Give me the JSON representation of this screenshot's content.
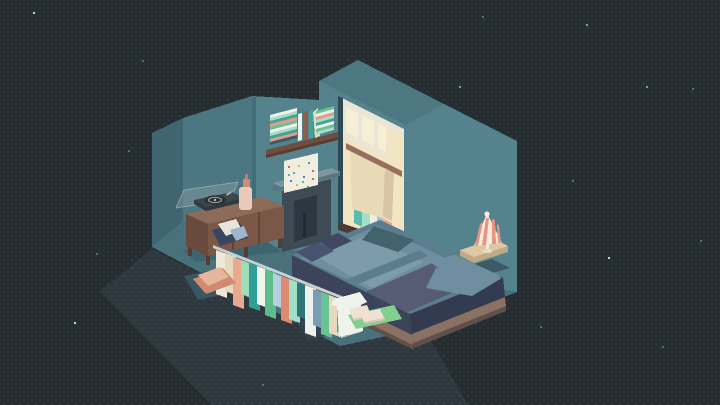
{
  "scene": {
    "description": "Isometric pixel-art bedroom diorama at night floating on a starry dark background",
    "objects": [
      "starry night background",
      "teal isometric room walls and roof",
      "record player on wooden sideboard",
      "pink bottle",
      "wall shelf with stacked books",
      "confetti wall art",
      "fireplace with mantel",
      "window with warm light",
      "closet nook with curtain and hanging clothes",
      "unmade bed with blue blankets",
      "bedside table with striped lamp",
      "clothes rack with hanging shirts",
      "peach floor cushion on rug",
      "slippers on green mat"
    ]
  },
  "palette": {
    "bg": "#262d31",
    "bg_dot": "#353d41",
    "star_white": "#c7d6d6",
    "star_teal": "#6fa3a8",
    "star_dim": "#5d6d72",
    "left_wall": "#4b7682",
    "left_wall_side": "#3f6570",
    "back_wall": "#54828d",
    "roof": "#4d7882",
    "corner_shade": "#436d78",
    "floor": "#48717c",
    "floor_shadow": "#3e6470",
    "bed_shadow": "#3a5a66",
    "rug_dark": "#3a5563",
    "rug_navy": "#3c4a66",
    "step_dark": "#32434e",
    "apron": "rgba(96,124,142,0.14)",
    "cabinet_top": "#8c6b59",
    "cabinet_front": "#7a5747",
    "cabinet_side": "#6a4a3c",
    "cabinet_leg": "#563c30",
    "cabinet_line": "#5f443a",
    "record_body": "#3c454b",
    "record_edge": "#31393e",
    "record_disc": "#2b3238",
    "record_ring": "#98a2a8",
    "record_lid": "rgba(158,170,176,0.35)",
    "bottle_body": "#eac9bb",
    "bottle_neck": "#d28a79",
    "bottle_tip": "#c97b68",
    "shelf_wood": "#6f4e3f",
    "shelf_edge": "#5a3d31",
    "art_bg": "#f0ede1",
    "art_speckles": [
      "#d95f54",
      "#52b3a8",
      "#e0b84f",
      "#4f7fc9",
      "#5a9e6f"
    ],
    "mantel_top": "#7e969e",
    "mantel_front": "#5d747d",
    "fireplace_body": "#3f4b54",
    "fireplace_inner": "#2c3840",
    "fireplace_detail": "#1f292f",
    "window_frame": "#e9e6d6",
    "closet_warm": "#f2e5c3",
    "closet_glow": "#f7eed6",
    "closet_rod": "#96705c",
    "curtain": "#e8d9b7",
    "curtain_shade": "#d8c5a1",
    "closet_floor": "#4c3a33",
    "alcove_shadow": "#2e4a54",
    "closet_clothes": [
      "#59bab1",
      "#a4dfc8",
      "#eef0e8",
      "#9fc2d4",
      "#e2a78d"
    ],
    "blanket_base": "#5c7d8e",
    "blanket_light": "#6f8fa0",
    "blanket_lighter": "#7d9cab",
    "blanket_purple": "#575c75",
    "blanket_teal": "#42636d",
    "pillow_navy": "#49526e",
    "pillow_dark": "#3f4860",
    "bed_side": "#3b4459",
    "bed_side_dark": "#333b50",
    "bed_wood": "#8b7164",
    "bed_wood_dark": "#60504a",
    "nightstand_top": "#dcc8a4",
    "nightstand_side": "#bfa987",
    "lamp_cream": "#f6eadd",
    "lamp_coral": "#e59582",
    "lamp_stem": "#f2e9d8",
    "lamp_base": "#e8dcc8",
    "rack_metal": "#c3d2d2",
    "shirts": [
      "#ece9da",
      "#e7d9bd",
      "#e8a98e",
      "#9fdcb8",
      "#2f9e96",
      "#f0f2ec",
      "#5cbc8c",
      "#b7cfdc",
      "#dd8a72",
      "#a4dfc8",
      "#2e7778",
      "#eef2ee",
      "#7a9cb5",
      "#67c294",
      "#e7d9bd",
      "#42a39b"
    ],
    "tee": "#f0f2ec",
    "cloth_navy": "#3a4563",
    "cloth_white": "#e8e4da",
    "cloth_blue": "#9fb6c8",
    "mat_green": "#83cf8e",
    "slipper": "#f0e2d3",
    "slipper_shade": "#dcc6b2",
    "cushion": "#d08a72",
    "cushion_light": "#e7b49c",
    "books_left": [
      "#3a5a64",
      "#e49c86",
      "#42a39b",
      "#a9ddc5",
      "#f0f1ea",
      "#67c294",
      "#e49c86",
      "#42a39b",
      "#a9ddc5",
      "#f0f1ea"
    ],
    "books_right": [
      "#a9ddc5",
      "#67c294",
      "#f0f1ea",
      "#42a39b",
      "#a9ddc5",
      "#e49c86",
      "#f0f1ea",
      "#67c294"
    ],
    "books_vert": [
      "#f0f1ea",
      "#8a5f4c",
      "#42a39b",
      "#e7d9bd"
    ]
  }
}
